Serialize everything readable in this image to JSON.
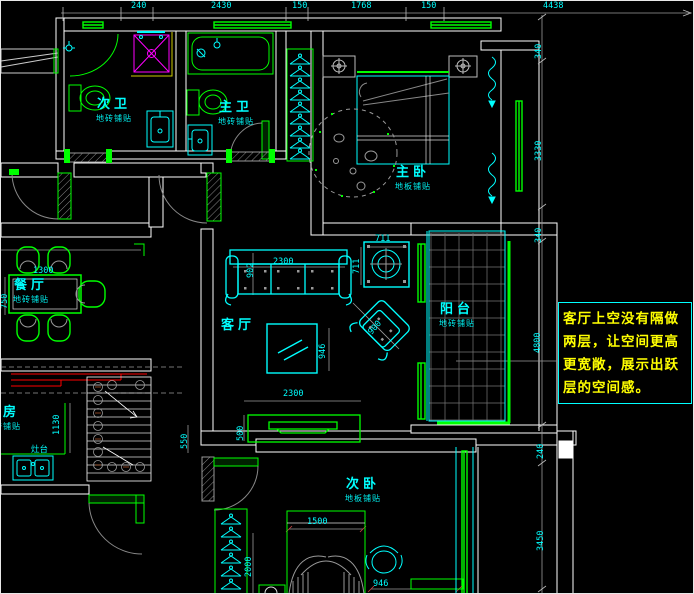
{
  "colors": {
    "background": "#000000",
    "wall_line": "#ffffff",
    "furniture_green": "#00ff00",
    "furniture_cyan": "#00ffff",
    "dim_text": "#00ffff",
    "note_text": "#ffff00",
    "note_border": "#00ffff",
    "kitchen_counter_red": "#ff0000",
    "construction_gray": "#999999",
    "shower_magenta": "#ff00ff"
  },
  "note": {
    "lines": [
      "客厅上空没有隔做",
      "两层，让空间更高",
      "更宽敞，展示出跃",
      "层的空间感。"
    ]
  },
  "rooms": [
    {
      "id": "bath-secondary",
      "name": "次卫",
      "sub": "地砖铺贴",
      "x": 95,
      "y": 97
    },
    {
      "id": "bath-master",
      "name": "主卫",
      "sub": "地砖铺贴",
      "x": 217,
      "y": 100
    },
    {
      "id": "bedroom-master",
      "name": "主卧",
      "sub": "地板铺贴",
      "x": 394,
      "y": 165
    },
    {
      "id": "dining",
      "name": "餐厅",
      "sub": "地砖铺贴",
      "x": 12,
      "y": 278
    },
    {
      "id": "living",
      "name": "客厅",
      "sub": "",
      "x": 220,
      "y": 318
    },
    {
      "id": "balcony",
      "name": "阳台",
      "sub": "地砖铺贴",
      "x": 438,
      "y": 302
    },
    {
      "id": "kitchen",
      "name": "厨房",
      "sub": "地砖铺贴",
      "x": -16,
      "y": 405
    },
    {
      "id": "bedroom-secondary",
      "name": "次卧",
      "sub": "地板铺贴",
      "x": 344,
      "y": 477
    }
  ],
  "dimensions": [
    {
      "text": "240",
      "x": 130,
      "y": 1,
      "rot": 0
    },
    {
      "text": "2430",
      "x": 210,
      "y": 1,
      "rot": 0
    },
    {
      "text": "150",
      "x": 291,
      "y": 1,
      "rot": 0
    },
    {
      "text": "1768",
      "x": 350,
      "y": 1,
      "rot": 0
    },
    {
      "text": "150",
      "x": 420,
      "y": 1,
      "rot": 0
    },
    {
      "text": "4438",
      "x": 542,
      "y": 1,
      "rot": 0
    },
    {
      "text": "340",
      "x": 534,
      "y": 58,
      "rot": -90
    },
    {
      "text": "3330",
      "x": 534,
      "y": 160,
      "rot": -90
    },
    {
      "text": "340",
      "x": 534,
      "y": 242,
      "rot": -90
    },
    {
      "text": "4800",
      "x": 533,
      "y": 352,
      "rot": -90
    },
    {
      "text": "240",
      "x": 536,
      "y": 458,
      "rot": -90
    },
    {
      "text": "3450",
      "x": 536,
      "y": 550,
      "rot": -90
    },
    {
      "text": "2300",
      "x": 272,
      "y": 257,
      "rot": 0
    },
    {
      "text": "902",
      "x": 246,
      "y": 277,
      "rot": -90
    },
    {
      "text": "711",
      "x": 374,
      "y": 234,
      "rot": 0
    },
    {
      "text": "711",
      "x": 352,
      "y": 273,
      "rot": -90
    },
    {
      "text": "900",
      "x": 366,
      "y": 330,
      "rot": -48
    },
    {
      "text": "946",
      "x": 318,
      "y": 358,
      "rot": -90
    },
    {
      "text": "2300",
      "x": 282,
      "y": 389,
      "rot": 0
    },
    {
      "text": "500",
      "x": 236,
      "y": 440,
      "rot": -90
    },
    {
      "text": "1300",
      "x": 32,
      "y": 266,
      "rot": 0
    },
    {
      "text": "750",
      "x": 0,
      "y": 308,
      "rot": -90
    },
    {
      "text": "550",
      "x": 180,
      "y": 448,
      "rot": -90
    },
    {
      "text": "1130",
      "x": 52,
      "y": 434,
      "rot": -90
    },
    {
      "text": "1500",
      "x": 306,
      "y": 517,
      "rot": 0
    },
    {
      "text": "2000",
      "x": 244,
      "y": 576,
      "rot": -90
    },
    {
      "text": "946",
      "x": 372,
      "y": 579,
      "rot": 0
    }
  ],
  "extra_labels": [
    {
      "text": "灶台",
      "x": 30,
      "y": 445,
      "rot": 0
    }
  ]
}
